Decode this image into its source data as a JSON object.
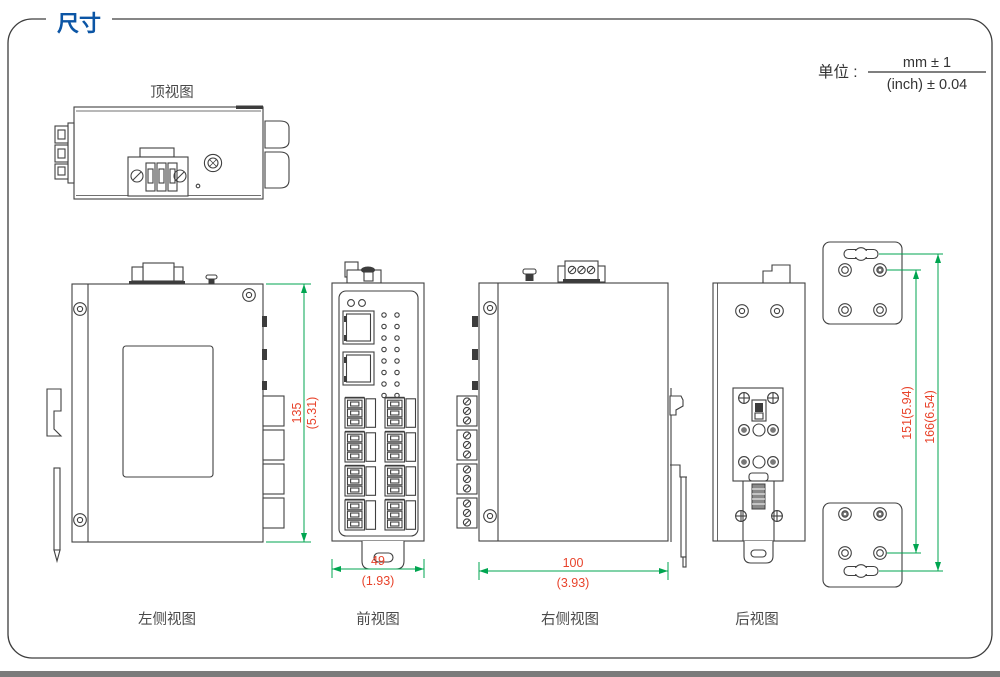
{
  "header": {
    "title": "尺寸",
    "unit_label": "单位 :",
    "unit_numerator": "mm ± 1",
    "unit_denominator": "(inch) ± 0.04"
  },
  "views": {
    "top": {
      "label": "顶视图"
    },
    "left_side": {
      "label": "左侧视图"
    },
    "front": {
      "label": "前视图"
    },
    "right_side": {
      "label": "右侧视图"
    },
    "rear": {
      "label": "后视图"
    }
  },
  "dims": {
    "height_mm": "135",
    "height_inch": "(5.31)",
    "front_width_mm": "49",
    "front_width_inch": "(1.93)",
    "side_width_mm": "100",
    "side_width_inch": "(3.93)",
    "mount_hole_span": "151(5.94)",
    "mount_slot_span": "166(6.54)"
  },
  "colors": {
    "title_blue": "#0b55a5",
    "dimension_line_green": "#00a550",
    "dimension_text_red": "#e8432b",
    "drawing_stroke": "#404040"
  }
}
